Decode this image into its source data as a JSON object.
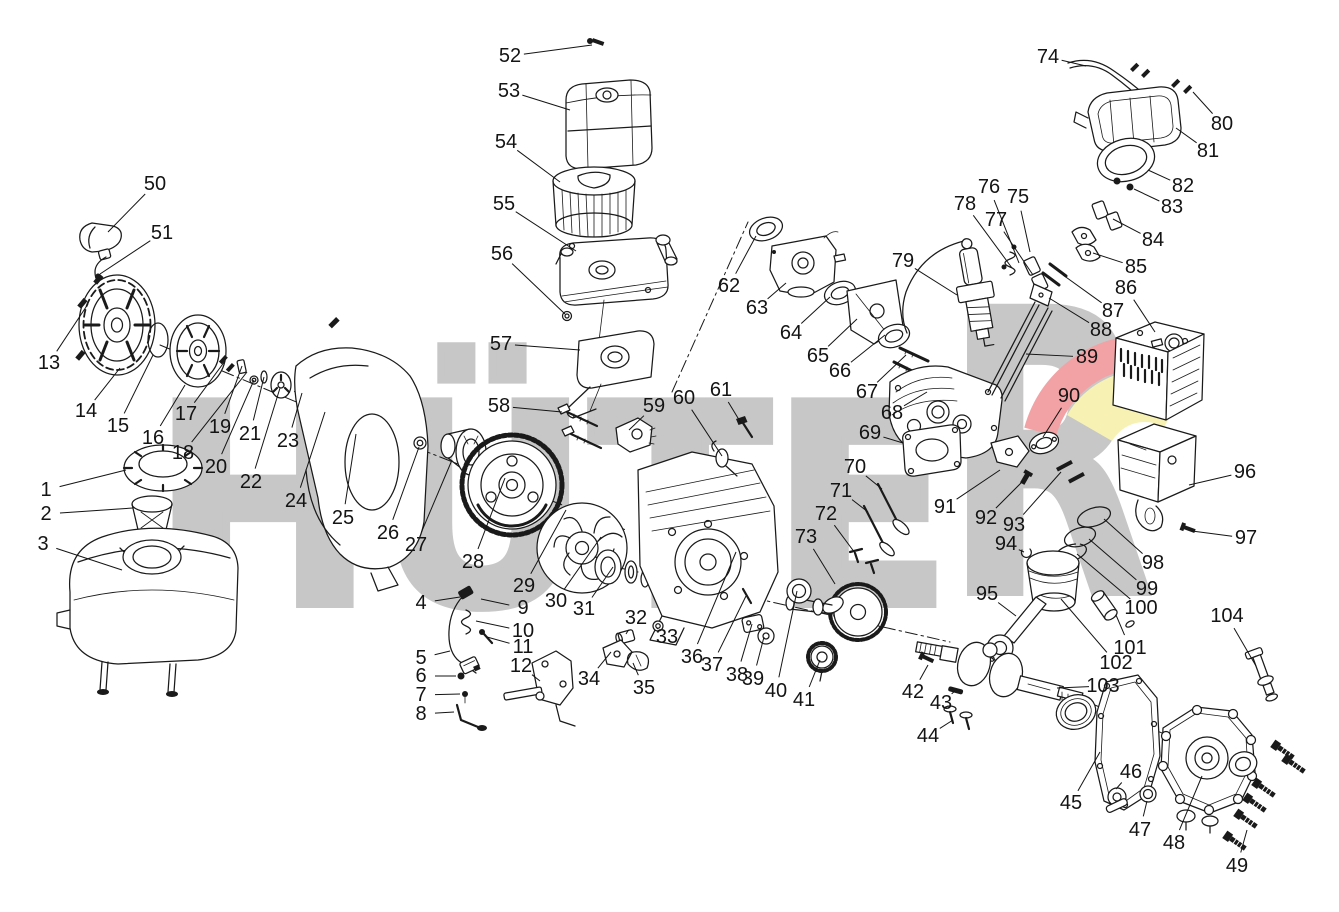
{
  "page": {
    "background": "#ffffff",
    "line_color": "#1a1a1a",
    "label_color": "#141414"
  },
  "watermark": {
    "brand": "HÜTER",
    "main": "HÜTE",
    "r": "R",
    "letter_color": "#c7c7c7",
    "swoosh_red": "#f2a2a4",
    "swoosh_yellow": "#f7f2b4"
  },
  "diagram": {
    "type": "exploded-parts-diagram",
    "labels": [
      {
        "n": "1",
        "x": 46,
        "y": 490,
        "tx": 126,
        "ty": 470
      },
      {
        "n": "2",
        "x": 46,
        "y": 514,
        "tx": 133,
        "ty": 508
      },
      {
        "n": "3",
        "x": 43,
        "y": 544,
        "tx": 122,
        "ty": 570
      },
      {
        "n": "4",
        "x": 421,
        "y": 603,
        "tx": 460,
        "ty": 597
      },
      {
        "n": "5",
        "x": 421,
        "y": 658,
        "tx": 450,
        "ty": 651
      },
      {
        "n": "6",
        "x": 421,
        "y": 676,
        "tx": 456,
        "ty": 676
      },
      {
        "n": "7",
        "x": 421,
        "y": 695,
        "tx": 460,
        "ty": 694
      },
      {
        "n": "8",
        "x": 421,
        "y": 714,
        "tx": 454,
        "ty": 712
      },
      {
        "n": "9",
        "x": 523,
        "y": 608,
        "tx": 481,
        "ty": 599
      },
      {
        "n": "10",
        "x": 523,
        "y": 631,
        "tx": 476,
        "ty": 621
      },
      {
        "n": "11",
        "x": 523,
        "y": 647,
        "tx": 487,
        "ty": 637
      },
      {
        "n": "12",
        "x": 521,
        "y": 666,
        "tx": 540,
        "ty": 681
      },
      {
        "n": "13",
        "x": 49,
        "y": 363,
        "tx": 88,
        "ty": 304
      },
      {
        "n": "14",
        "x": 86,
        "y": 411,
        "tx": 120,
        "ty": 368
      },
      {
        "n": "15",
        "x": 118,
        "y": 426,
        "tx": 153,
        "ty": 355
      },
      {
        "n": "16",
        "x": 153,
        "y": 438,
        "tx": 185,
        "ty": 385
      },
      {
        "n": "17",
        "x": 186,
        "y": 414,
        "tx": 225,
        "ty": 361
      },
      {
        "n": "18",
        "x": 183,
        "y": 453,
        "tx": 247,
        "ty": 372
      },
      {
        "n": "19",
        "x": 220,
        "y": 427,
        "tx": 242,
        "ty": 366
      },
      {
        "n": "20",
        "x": 216,
        "y": 467,
        "tx": 254,
        "ty": 380
      },
      {
        "n": "21",
        "x": 250,
        "y": 434,
        "tx": 264,
        "ty": 377
      },
      {
        "n": "22",
        "x": 251,
        "y": 482,
        "tx": 280,
        "ty": 388
      },
      {
        "n": "23",
        "x": 288,
        "y": 441,
        "tx": 302,
        "ty": 393
      },
      {
        "n": "24",
        "x": 296,
        "y": 501,
        "tx": 325,
        "ty": 412
      },
      {
        "n": "25",
        "x": 343,
        "y": 518,
        "tx": 356,
        "ty": 434
      },
      {
        "n": "26",
        "x": 388,
        "y": 533,
        "tx": 419,
        "ty": 447
      },
      {
        "n": "27",
        "x": 416,
        "y": 545,
        "tx": 452,
        "ty": 460
      },
      {
        "n": "28",
        "x": 473,
        "y": 562,
        "tx": 505,
        "ty": 478
      },
      {
        "n": "29",
        "x": 524,
        "y": 586,
        "tx": 566,
        "ty": 510
      },
      {
        "n": "30",
        "x": 556,
        "y": 601,
        "tx": 601,
        "ty": 537
      },
      {
        "n": "31",
        "x": 584,
        "y": 609,
        "tx": 613,
        "ty": 567
      },
      {
        "n": "32",
        "x": 636,
        "y": 618,
        "tx": 626,
        "ty": 634
      },
      {
        "n": "33",
        "x": 667,
        "y": 637,
        "tx": 658,
        "ty": 629
      },
      {
        "n": "34",
        "x": 589,
        "y": 679,
        "tx": 611,
        "ty": 652
      },
      {
        "n": "35",
        "x": 644,
        "y": 688,
        "tx": 633,
        "ty": 663
      },
      {
        "n": "36",
        "x": 692,
        "y": 657,
        "tx": 736,
        "ty": 552
      },
      {
        "n": "37",
        "x": 712,
        "y": 665,
        "tx": 746,
        "ty": 596
      },
      {
        "n": "38",
        "x": 737,
        "y": 675,
        "tx": 752,
        "ty": 624
      },
      {
        "n": "39",
        "x": 753,
        "y": 679,
        "tx": 764,
        "ty": 637
      },
      {
        "n": "40",
        "x": 776,
        "y": 691,
        "tx": 797,
        "ty": 591
      },
      {
        "n": "41",
        "x": 804,
        "y": 700,
        "tx": 820,
        "ty": 660
      },
      {
        "n": "42",
        "x": 913,
        "y": 692,
        "tx": 928,
        "ty": 665
      },
      {
        "n": "43",
        "x": 941,
        "y": 703,
        "tx": 955,
        "ty": 691
      },
      {
        "n": "44",
        "x": 928,
        "y": 736,
        "tx": 953,
        "ty": 720
      },
      {
        "n": "45",
        "x": 1071,
        "y": 803,
        "tx": 1100,
        "ty": 752
      },
      {
        "n": "46",
        "x": 1131,
        "y": 772,
        "tx": 1116,
        "ty": 789
      },
      {
        "n": "47",
        "x": 1140,
        "y": 830,
        "tx": 1147,
        "ty": 801
      },
      {
        "n": "48",
        "x": 1174,
        "y": 843,
        "tx": 1202,
        "ty": 776
      },
      {
        "n": "49",
        "x": 1237,
        "y": 866,
        "tx": 1247,
        "ty": 830
      },
      {
        "n": "50",
        "x": 155,
        "y": 184,
        "tx": 108,
        "ty": 232
      },
      {
        "n": "51",
        "x": 162,
        "y": 233,
        "tx": 100,
        "ty": 274
      },
      {
        "n": "52",
        "x": 510,
        "y": 56,
        "tx": 592,
        "ty": 45
      },
      {
        "n": "53",
        "x": 509,
        "y": 91,
        "tx": 570,
        "ty": 110
      },
      {
        "n": "54",
        "x": 506,
        "y": 142,
        "tx": 560,
        "ty": 182
      },
      {
        "n": "55",
        "x": 504,
        "y": 204,
        "tx": 576,
        "ty": 251
      },
      {
        "n": "56",
        "x": 502,
        "y": 254,
        "tx": 565,
        "ty": 314
      },
      {
        "n": "57",
        "x": 501,
        "y": 344,
        "tx": 580,
        "ty": 350
      },
      {
        "n": "58",
        "x": 499,
        "y": 406,
        "tx": 562,
        "ty": 412
      },
      {
        "n": "59",
        "x": 654,
        "y": 406,
        "tx": 629,
        "ty": 430
      },
      {
        "n": "60",
        "x": 684,
        "y": 398,
        "tx": 722,
        "ty": 456
      },
      {
        "n": "61",
        "x": 721,
        "y": 390,
        "tx": 741,
        "ty": 423
      },
      {
        "n": "62",
        "x": 729,
        "y": 286,
        "tx": 756,
        "ty": 236
      },
      {
        "n": "63",
        "x": 757,
        "y": 308,
        "tx": 786,
        "ty": 283
      },
      {
        "n": "64",
        "x": 791,
        "y": 333,
        "tx": 830,
        "ty": 297
      },
      {
        "n": "65",
        "x": 818,
        "y": 356,
        "tx": 857,
        "ty": 319
      },
      {
        "n": "66",
        "x": 840,
        "y": 371,
        "tx": 885,
        "ty": 335
      },
      {
        "n": "67",
        "x": 867,
        "y": 392,
        "tx": 906,
        "ty": 355
      },
      {
        "n": "68",
        "x": 892,
        "y": 413,
        "tx": 927,
        "ty": 392
      },
      {
        "n": "69",
        "x": 870,
        "y": 433,
        "tx": 903,
        "ty": 443
      },
      {
        "n": "70",
        "x": 855,
        "y": 467,
        "tx": 882,
        "ty": 489
      },
      {
        "n": "71",
        "x": 841,
        "y": 491,
        "tx": 868,
        "ty": 512
      },
      {
        "n": "72",
        "x": 826,
        "y": 514,
        "tx": 855,
        "ty": 553
      },
      {
        "n": "73",
        "x": 806,
        "y": 537,
        "tx": 835,
        "ty": 584
      },
      {
        "n": "74",
        "x": 1048,
        "y": 57,
        "tx": 1086,
        "ty": 66
      },
      {
        "n": "75",
        "x": 1018,
        "y": 197,
        "tx": 1030,
        "ty": 252
      },
      {
        "n": "76",
        "x": 989,
        "y": 187,
        "tx": 1019,
        "ty": 263
      },
      {
        "n": "77",
        "x": 996,
        "y": 220,
        "tx": 1033,
        "ty": 275
      },
      {
        "n": "78",
        "x": 965,
        "y": 204,
        "tx": 1012,
        "ty": 268
      },
      {
        "n": "79",
        "x": 903,
        "y": 261,
        "tx": 957,
        "ty": 295
      },
      {
        "n": "80",
        "x": 1222,
        "y": 124,
        "tx": 1193,
        "ty": 92
      },
      {
        "n": "81",
        "x": 1208,
        "y": 151,
        "tx": 1176,
        "ty": 128
      },
      {
        "n": "82",
        "x": 1183,
        "y": 186,
        "tx": 1148,
        "ty": 170
      },
      {
        "n": "83",
        "x": 1172,
        "y": 207,
        "tx": 1134,
        "ty": 189
      },
      {
        "n": "84",
        "x": 1153,
        "y": 240,
        "tx": 1113,
        "ty": 219
      },
      {
        "n": "85",
        "x": 1136,
        "y": 267,
        "tx": 1093,
        "ty": 253
      },
      {
        "n": "86",
        "x": 1126,
        "y": 288,
        "tx": 1155,
        "ty": 332
      },
      {
        "n": "87",
        "x": 1113,
        "y": 311,
        "tx": 1063,
        "ty": 275
      },
      {
        "n": "88",
        "x": 1101,
        "y": 330,
        "tx": 1049,
        "ty": 298
      },
      {
        "n": "89",
        "x": 1087,
        "y": 357,
        "tx": 1026,
        "ty": 354
      },
      {
        "n": "90",
        "x": 1069,
        "y": 396,
        "tx": 1043,
        "ty": 437
      },
      {
        "n": "91",
        "x": 945,
        "y": 507,
        "tx": 1000,
        "ty": 470
      },
      {
        "n": "92",
        "x": 986,
        "y": 518,
        "tx": 1023,
        "ty": 481
      },
      {
        "n": "93",
        "x": 1014,
        "y": 525,
        "tx": 1061,
        "ty": 472
      },
      {
        "n": "94",
        "x": 1006,
        "y": 544,
        "tx": 1024,
        "ty": 552
      },
      {
        "n": "95",
        "x": 987,
        "y": 594,
        "tx": 1016,
        "ty": 616
      },
      {
        "n": "96",
        "x": 1245,
        "y": 472,
        "tx": 1189,
        "ty": 485
      },
      {
        "n": "97",
        "x": 1246,
        "y": 538,
        "tx": 1192,
        "ty": 531
      },
      {
        "n": "98",
        "x": 1153,
        "y": 563,
        "tx": 1104,
        "ty": 519
      },
      {
        "n": "99",
        "x": 1147,
        "y": 589,
        "tx": 1089,
        "ty": 539
      },
      {
        "n": "100",
        "x": 1141,
        "y": 608,
        "tx": 1077,
        "ty": 554
      },
      {
        "n": "101",
        "x": 1130,
        "y": 648,
        "tx": 1116,
        "ty": 615
      },
      {
        "n": "102",
        "x": 1116,
        "y": 663,
        "tx": 1061,
        "ty": 599
      },
      {
        "n": "103",
        "x": 1103,
        "y": 686,
        "tx": 1057,
        "ty": 688
      },
      {
        "n": "104",
        "x": 1227,
        "y": 616,
        "tx": 1256,
        "ty": 666
      }
    ]
  }
}
